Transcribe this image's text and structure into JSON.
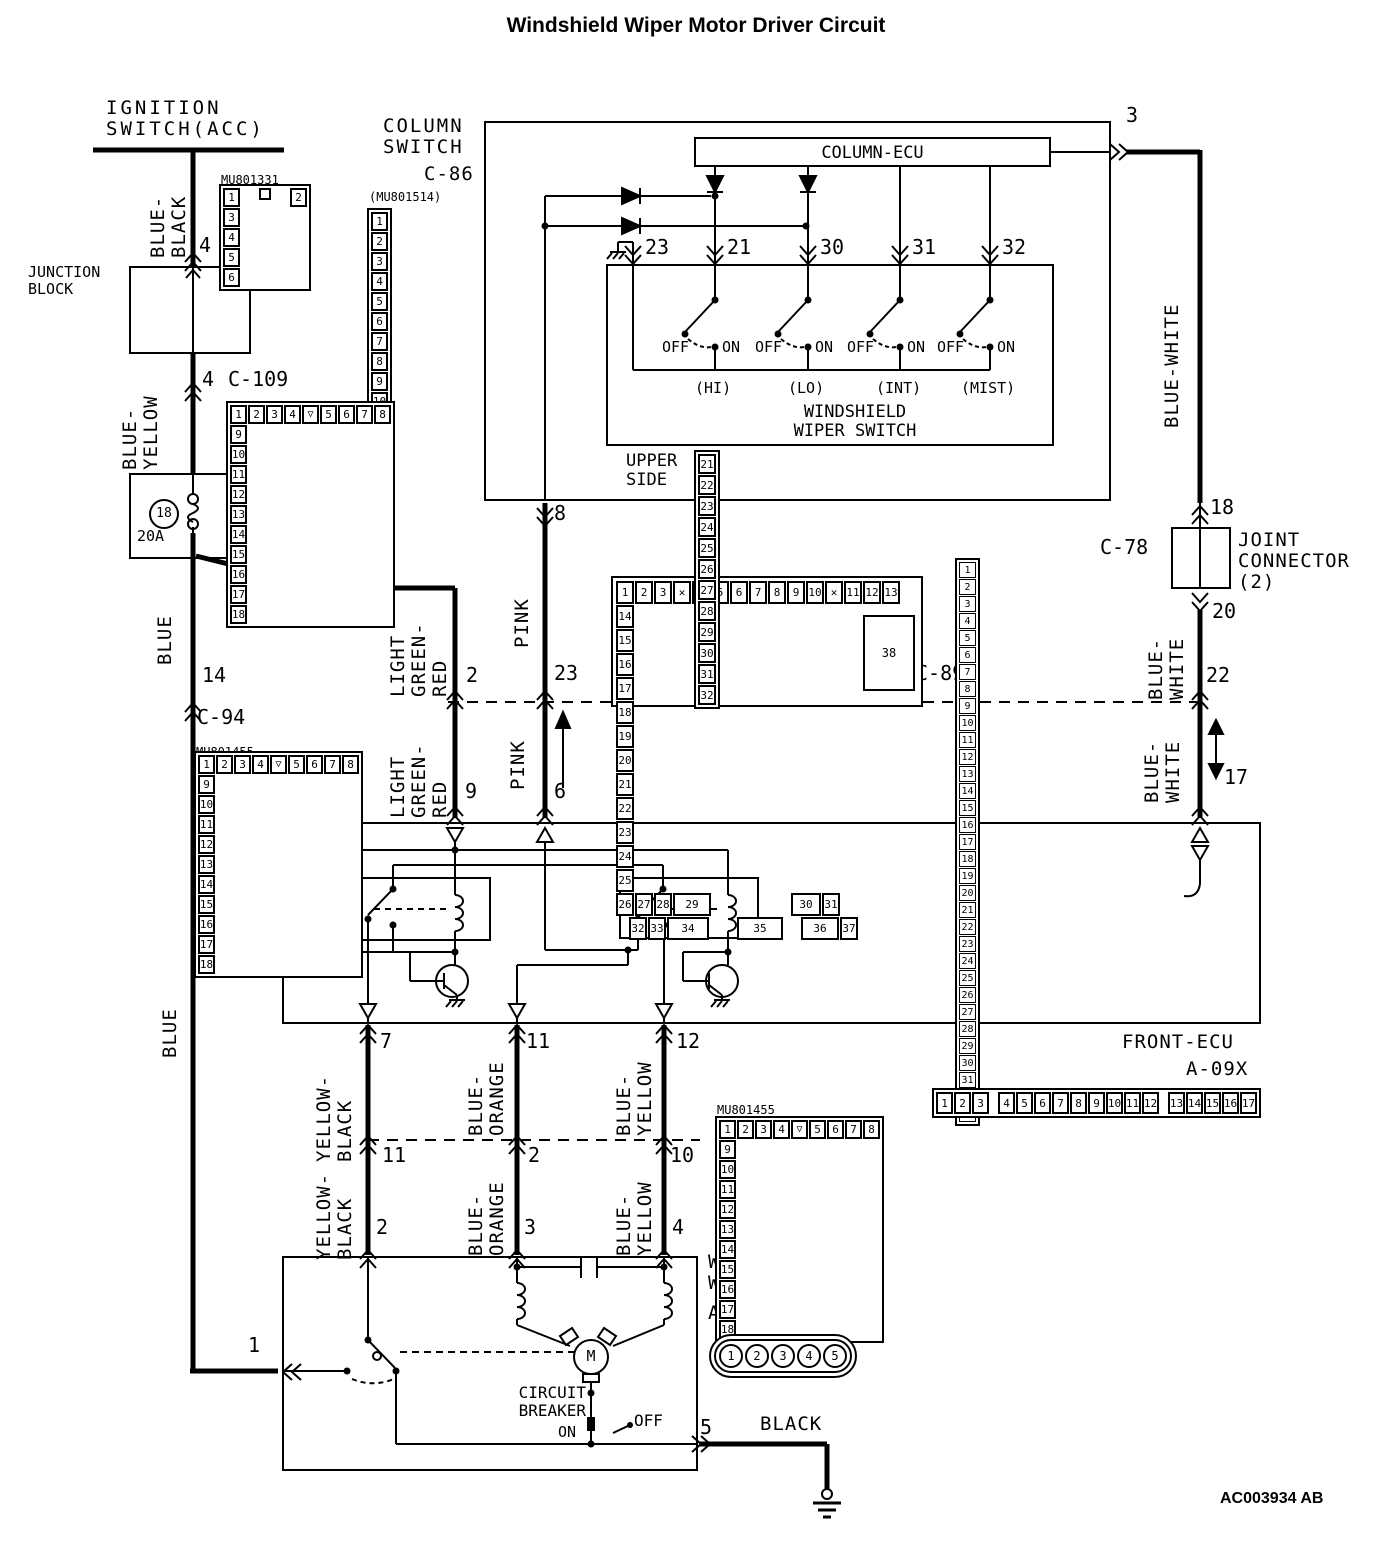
{
  "title": "Windshield Wiper Motor Driver Circuit",
  "footer_code": "AC003934 AB",
  "glyphs": {
    "notch": "▽",
    "x_mark": "✕"
  },
  "pin_labels": {
    "1": "1",
    "2": "2",
    "3": "3",
    "4": "4",
    "5": "5",
    "6": "6",
    "7": "7",
    "8": "8",
    "9": "9",
    "10": "10",
    "11": "11",
    "12": "12",
    "14": "14",
    "17": "17",
    "18": "18",
    "20": "20",
    "22": "22",
    "23": "23"
  },
  "power": {
    "ignition": "IGNITION\nSWITCH(ACC)",
    "junction_block": "JUNCTION\nBLOCK",
    "fuse_title": "DEDICATED\nFUSE",
    "fuse_no": "18",
    "fuse_rating": "20A"
  },
  "wires": {
    "blue_black": "BLUE-\nBLACK",
    "blue_yellow": "BLUE-\nYELLOW",
    "blue": "BLUE",
    "pink": "PINK",
    "light_green_red": "LIGHT\nGREEN-\nRED",
    "blue_white": "BLUE-WHITE",
    "blue_white_2": "BLUE-\nWHITE",
    "yellow_black": "YELLOW-\nBLACK",
    "blue_orange": "BLUE-\nORANGE",
    "blue_yellow_2": "BLUE-\nYELLOW",
    "black": "BLACK"
  },
  "column_switch": {
    "name": "COLUMN\nSWITCH",
    "code": "C-86",
    "part": "(MU801514)",
    "ecu": "COLUMN-ECU",
    "pins": [
      "23",
      "21",
      "30",
      "31",
      "32"
    ],
    "off": "OFF",
    "on": "ON",
    "modes": [
      "(HI)",
      "(LO)",
      "(INT)",
      "(MIST)"
    ],
    "switch_name": "WINDSHIELD\nWIPER SWITCH",
    "upper_side": "UPPER\nSIDE"
  },
  "joint_connector": {
    "name": "JOINT\nCONNECTOR\n(2)"
  },
  "front_ecu": {
    "name": "FRONT-ECU",
    "code": "A-09X"
  },
  "motor": {
    "name": "WINDSHIELD\nWIPER MOTOR",
    "code": "A-03",
    "part": "(MU802092)",
    "m": "M",
    "breaker": "CIRCUIT\nBREAKER",
    "on": "ON",
    "off": "OFF"
  },
  "connector_names": {
    "c101": "C-101",
    "c101_part": "MU801331",
    "c109": "C-109",
    "c94": "C-94",
    "c94_part": "MU801455",
    "c89": "C-89",
    "c78": "C-78",
    "c06": "C-06",
    "c06_part": "MU801455",
    "a03": "A-03"
  },
  "connectors": {
    "c101": {
      "top": [
        "1",
        "2"
      ],
      "bottom": [
        "3",
        "4",
        "5",
        "6"
      ]
    },
    "c86": {
      "r1": [
        "1",
        "2",
        "3",
        "4",
        "5"
      ],
      "r2": [
        "6",
        "7",
        "8",
        "9",
        "10"
      ]
    },
    "c109": {
      "r1a": [
        "1",
        "2",
        "3",
        "4"
      ],
      "r1b": [
        "5",
        "6",
        "7",
        "8"
      ],
      "r2": [
        "9",
        "10",
        "11",
        "12",
        "13",
        "14",
        "15",
        "16",
        "17",
        "18"
      ]
    },
    "c94": {
      "r1a": [
        "1",
        "2",
        "3",
        "4"
      ],
      "r1b": [
        "5",
        "6",
        "7",
        "8"
      ],
      "r2": [
        "9",
        "10",
        "11",
        "12",
        "13",
        "14",
        "15",
        "16",
        "17",
        "18"
      ]
    },
    "c06": {
      "r1a": [
        "1",
        "2",
        "3",
        "4"
      ],
      "r1b": [
        "5",
        "6",
        "7",
        "8"
      ],
      "r2": [
        "9",
        "10",
        "11",
        "12",
        "13",
        "14",
        "15",
        "16",
        "17",
        "18"
      ]
    },
    "c78": {
      "r1": [
        "1",
        "2",
        "3",
        "4",
        "5",
        "6",
        "7",
        "8",
        "9",
        "10",
        "11"
      ],
      "r2": [
        "12",
        "13",
        "14",
        "15",
        "16",
        "17",
        "18",
        "19",
        "20",
        "21",
        "22"
      ],
      "r3": [
        "23",
        "24",
        "25",
        "26",
        "27",
        "28",
        "29",
        "30",
        "31",
        "32",
        "33"
      ]
    },
    "c89": {
      "r1a": [
        "1",
        "2",
        "3"
      ],
      "r1b": [
        "4",
        "5",
        "6",
        "7",
        "8",
        "9",
        "10"
      ],
      "r1c": [
        "11",
        "12",
        "13"
      ],
      "r2": [
        "14",
        "15",
        "16",
        "17",
        "18",
        "19",
        "20",
        "21",
        "22",
        "23",
        "24",
        "25"
      ],
      "r3a": [
        "26",
        "27",
        "28"
      ],
      "p29": "29",
      "p30": "30",
      "p31": "31",
      "p38": "38",
      "r4a": [
        "32",
        "33"
      ],
      "p34": "34",
      "p35": "35",
      "p36": "36",
      "p37": "37"
    },
    "a09x": {
      "g1": [
        "1",
        "2",
        "3"
      ],
      "g2": [
        "4",
        "5",
        "6",
        "7",
        "8",
        "9",
        "10",
        "11",
        "12"
      ],
      "g3": [
        "13",
        "14",
        "15",
        "16",
        "17"
      ]
    },
    "a03": [
      "1",
      "2",
      "3",
      "4",
      "5"
    ],
    "upper_side": [
      "21",
      "22",
      "23",
      "24",
      "25",
      "26",
      "27",
      "28",
      "29",
      "30",
      "31",
      "32"
    ]
  }
}
